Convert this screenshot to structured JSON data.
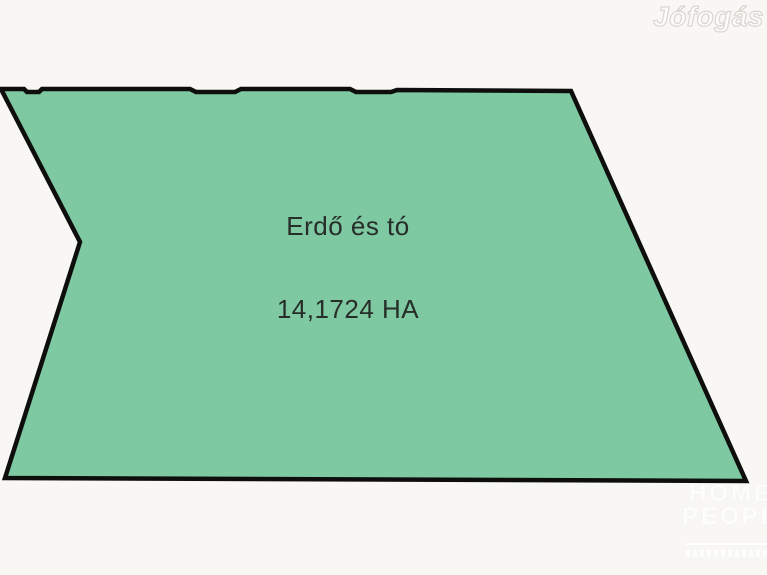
{
  "window": {
    "width": 767,
    "height": 575,
    "background_color": "#f8f7f4"
  },
  "site_watermark": {
    "text": "Jófogás"
  },
  "parcel": {
    "label": "Erdő és tó",
    "area": "14,1724 HA",
    "fill_color": "#7ec8a2",
    "border_color": "#0e0e0c",
    "border_width": "4.5",
    "outline_points": "1,89 24,89 27,92 39,92 42,89 190,89 196,92 235,92 241,89 350,89 356,92 391,92 397,90 571,91 746,481 5,478 80,242"
  },
  "agency_watermark": {
    "line1": "HOME",
    "line2": "PEOPLE"
  }
}
